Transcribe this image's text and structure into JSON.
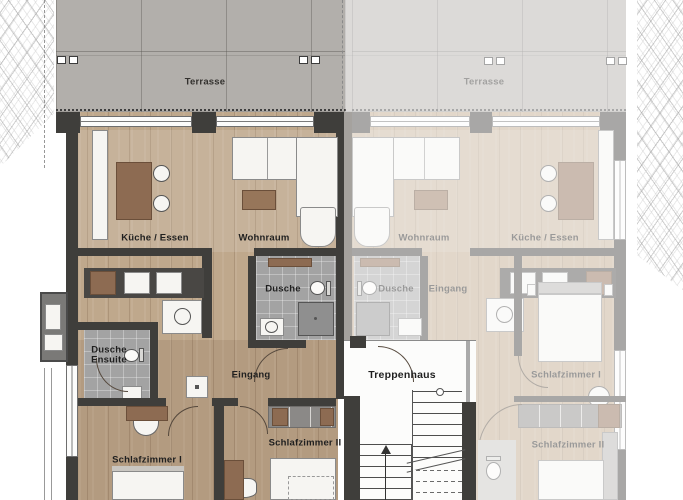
{
  "floor_plan": {
    "terrace_left": {
      "label": "Terrasse"
    },
    "terrace_right": {
      "label": "Terrasse"
    },
    "apartment_left": {
      "kitchen_label": "Küche / Essen",
      "living_label": "Wohnraum",
      "shower_label": "Dusche",
      "shower_ensuite_lines": [
        "Dusche",
        "Ensuite"
      ],
      "entry_label": "Eingang",
      "bedroom1_label": "Schlafzimmer I",
      "bedroom2_label": "Schlafzimmer II"
    },
    "stairwell": {
      "label": "Treppenhaus"
    },
    "apartment_right": {
      "kitchen_label": "Küche / Essen",
      "living_label": "Wohnraum",
      "shower_label": "Dusche",
      "entry_label": "Eingang",
      "bedroom1_label": "Schlafzimmer I",
      "bedroom2_label": "Schlafzimmer II"
    },
    "colors": {
      "wood_floor": "#bfa88c",
      "terrace_concrete": "#b2afab",
      "wall_dark": "#3f3e3b",
      "wall_light": "#a5a29e",
      "bath_tile": "#a3a3a3",
      "furniture_wood": "#8d6b52",
      "furniture_white": "#f6f5f2",
      "label_dark": "#1f1f1f",
      "faded_apartment_opacity": "0.45"
    }
  }
}
